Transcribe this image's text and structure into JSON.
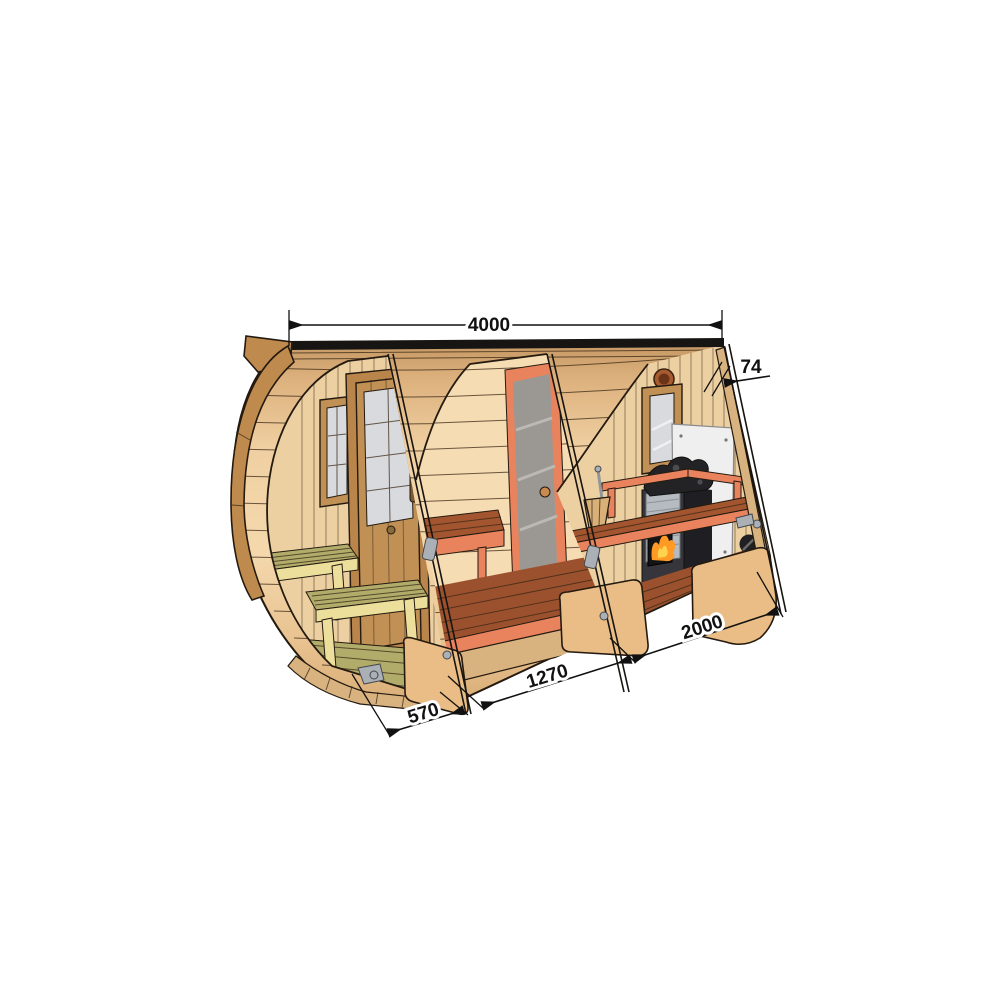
{
  "diagram": {
    "description": "Cutaway technical illustration of a barrel sauna with front terrace, middle room and stove room, annotated with dimensions"
  },
  "dimensions": {
    "overall_length": "4000",
    "wall_thickness": "74",
    "sauna_room_length": "2000",
    "middle_room_length": "1270",
    "terrace_length": "570"
  },
  "colors": {
    "outline": "#241a10",
    "dim": "#111111",
    "siding_light": "#f2d2a4",
    "roof_edge": "#161514",
    "rim": "#bf8a4d",
    "interior_wall": "#ecd0a2",
    "interior_wall_2": "#f6dcb2",
    "floor_red": "#9c512e",
    "bench_red": "#a2552f",
    "salmon": "#e8835d",
    "terrace_top": "#b2ac6b",
    "terrace_frame": "#ecdf9c",
    "door_wood": "#c09055",
    "glass": "#9b9894",
    "glass_light": "#d9dade",
    "shield": "#efefef",
    "stove_dark": "#35353b",
    "stove_side": "#1f1f23",
    "stove_panel": "#b5bbc0",
    "stone": "#232325",
    "fire": "#ff9a24",
    "fire_bright": "#ffd34d",
    "metal": "#aab0b6",
    "underside": "#d9b37f"
  }
}
